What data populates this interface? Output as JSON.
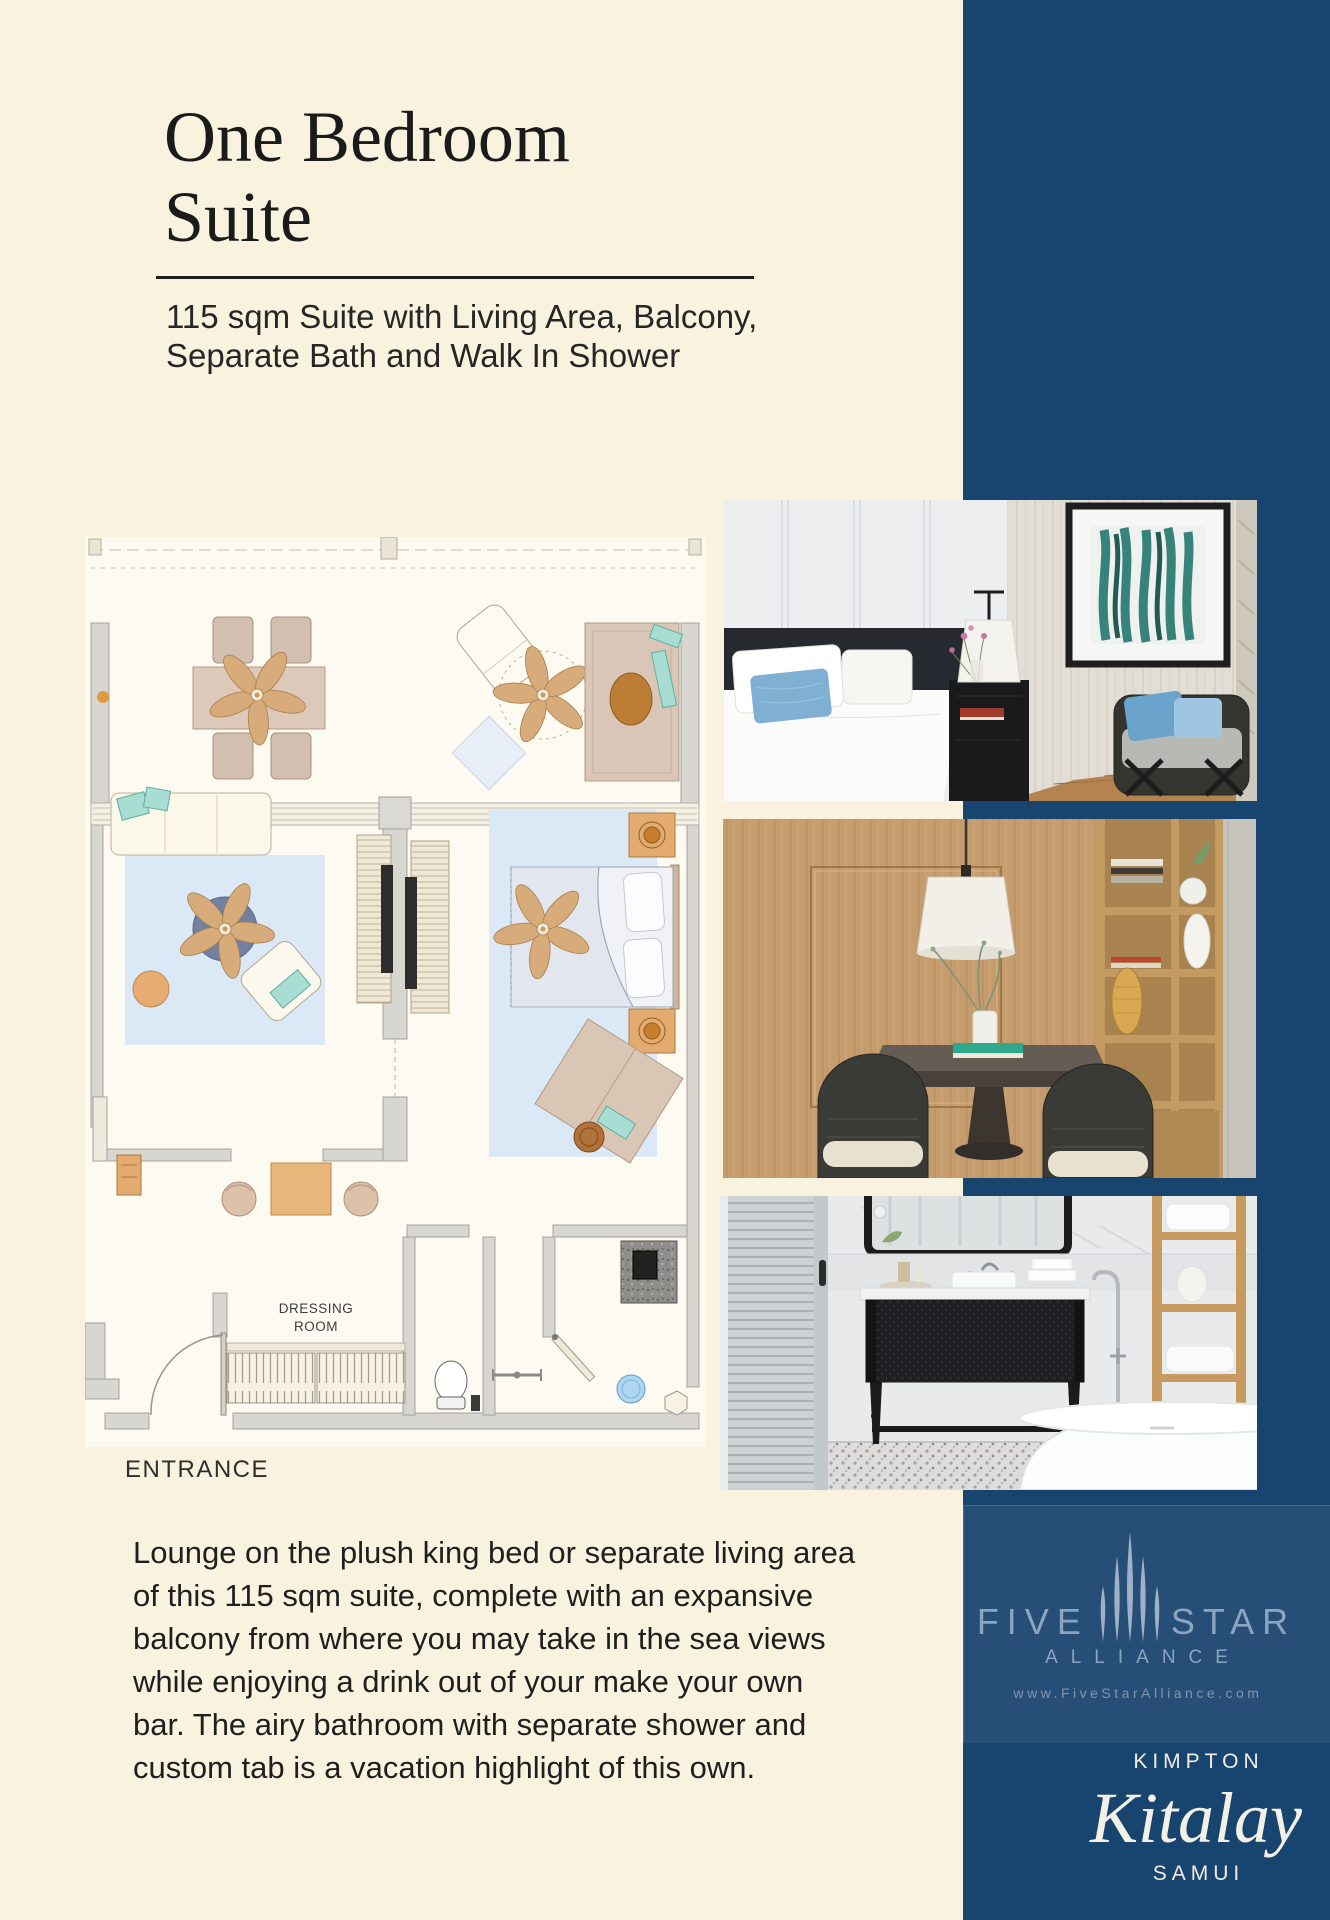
{
  "colors": {
    "page_background": "#f8f2de",
    "band_navy": "#18456f",
    "fivestar_background": "#274e76",
    "fivestar_text": "#8ba5c0",
    "brand_text": "#f0ece1",
    "title_text": "#1b1b1b"
  },
  "header": {
    "title": "One Bedroom\nSuite",
    "subtitle": "115 sqm Suite with Living Area, Balcony,\nSeparate Bath and Walk In Shower"
  },
  "floorplan": {
    "dressing_room_line1": "DRESSING",
    "dressing_room_line2": "ROOM",
    "entrance_label": "ENTRANCE"
  },
  "description": "Lounge on the plush king bed or separate living area\nof this 115 sqm suite, complete with an expansive\nbalcony from where you may take in the sea views\nwhile enjoying a drink out of your make your own\nbar. The airy bathroom with separate shower and\ncustom tab is a vacation highlight of this own.",
  "fivestar": {
    "word_left": "FIVE",
    "word_right": "STAR",
    "alliance": "ALLIANCE",
    "website": "www.FiveStarAlliance.com"
  },
  "brand": {
    "kimpton": "KIMPTON",
    "name": "Kitalay",
    "location": "SAMUI"
  }
}
